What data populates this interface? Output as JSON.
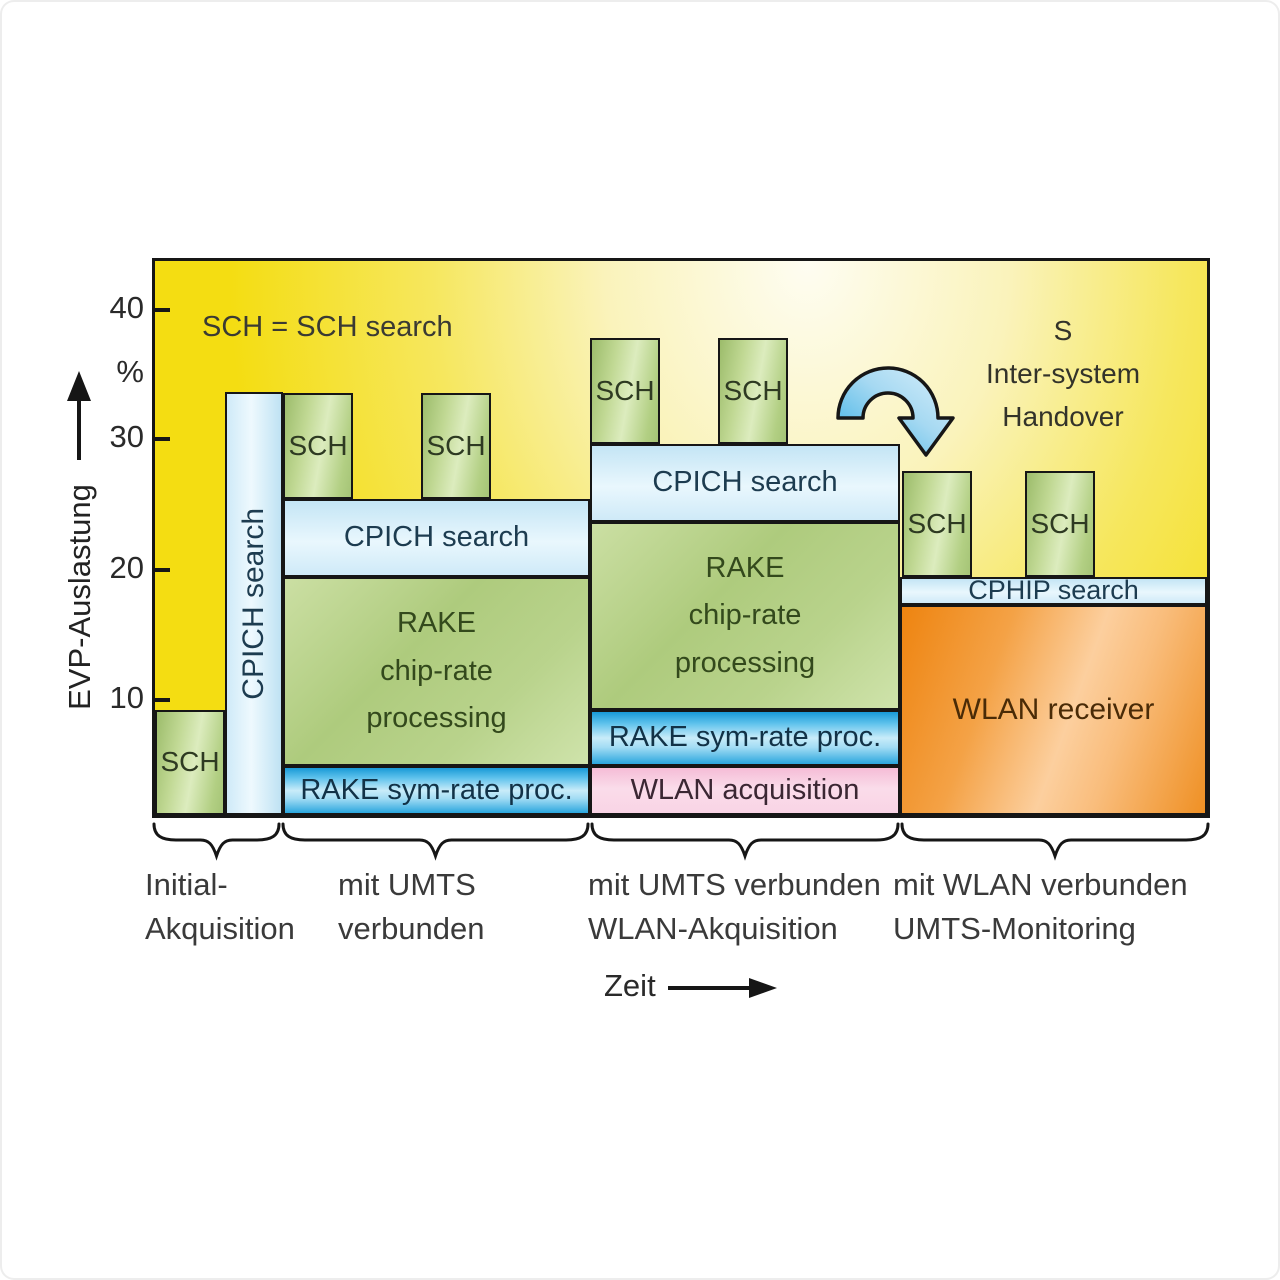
{
  "colors": {
    "background_yellow": "#f4dd12",
    "background_pale_center": "#fefdf2",
    "green_block": "#b7d18c",
    "light_blue_block": "#cfeaf8",
    "strong_blue_block": "#29a7df",
    "pink_block": "#f8cfe2",
    "orange_block": "#f0941e",
    "arrow_blue": "#7ccaee",
    "outline": "#161616"
  },
  "y_axis": {
    "tick_40": "40",
    "unit": "%",
    "tick_30": "30",
    "tick_20": "20",
    "tick_10": "10",
    "label": "EVP-Auslastung"
  },
  "x_axis": {
    "label": "Zeit"
  },
  "notes": {
    "legend": "SCH = SCH search",
    "handover_line1": "S",
    "handover_line2": "Inter-system",
    "handover_line3": "Handover"
  },
  "sections": [
    {
      "caption_line1": "Initial-",
      "caption_line2": "Akquisition",
      "blocks": {
        "sch": {
          "label": "SCH",
          "span_pct": [
            0,
            8
          ]
        },
        "cpich_vertical": {
          "label": "CPICH search",
          "span_pct": [
            0,
            33
          ]
        }
      }
    },
    {
      "caption_line1": "mit UMTS",
      "caption_line2": "verbunden",
      "blocks": {
        "sch_a": {
          "label": "SCH",
          "span_pct": [
            25,
            33
          ]
        },
        "sch_b": {
          "label": "SCH",
          "span_pct": [
            25,
            33
          ]
        },
        "cpich": {
          "label": "CPICH search",
          "span_pct": [
            19,
            25
          ]
        },
        "rake_chip": {
          "line1": "RAKE",
          "line2": "chip-rate",
          "line3": "processing",
          "span_pct": [
            4,
            19
          ]
        },
        "rake_sym": {
          "label": "RAKE sym-rate proc.",
          "span_pct": [
            0,
            4
          ]
        }
      }
    },
    {
      "caption_line1": "mit UMTS verbunden",
      "caption_line2": "WLAN-Akquisition",
      "blocks": {
        "sch_a": {
          "label": "SCH",
          "span_pct": [
            29,
            37
          ]
        },
        "sch_b": {
          "label": "SCH",
          "span_pct": [
            29,
            37
          ]
        },
        "cpich": {
          "label": "CPICH search",
          "span_pct": [
            23,
            29
          ]
        },
        "rake_chip": {
          "line1": "RAKE",
          "line2": "chip-rate",
          "line3": "processing",
          "span_pct": [
            8,
            23
          ]
        },
        "rake_sym": {
          "label": "RAKE sym-rate proc.",
          "span_pct": [
            4,
            8
          ]
        },
        "wlan_acq": {
          "label": "WLAN acquisition",
          "span_pct": [
            0,
            4
          ]
        }
      }
    },
    {
      "caption_line1": "mit WLAN verbunden",
      "caption_line2": "UMTS-Monitoring",
      "blocks": {
        "sch_a": {
          "label": "SCH",
          "span_pct": [
            19,
            27
          ]
        },
        "sch_b": {
          "label": "SCH",
          "span_pct": [
            19,
            27
          ]
        },
        "cphip": {
          "label": "CPHIP search",
          "span_pct": [
            17,
            19
          ]
        },
        "wlan_rx": {
          "label": "WLAN receiver",
          "span_pct": [
            0,
            17
          ]
        }
      }
    }
  ]
}
